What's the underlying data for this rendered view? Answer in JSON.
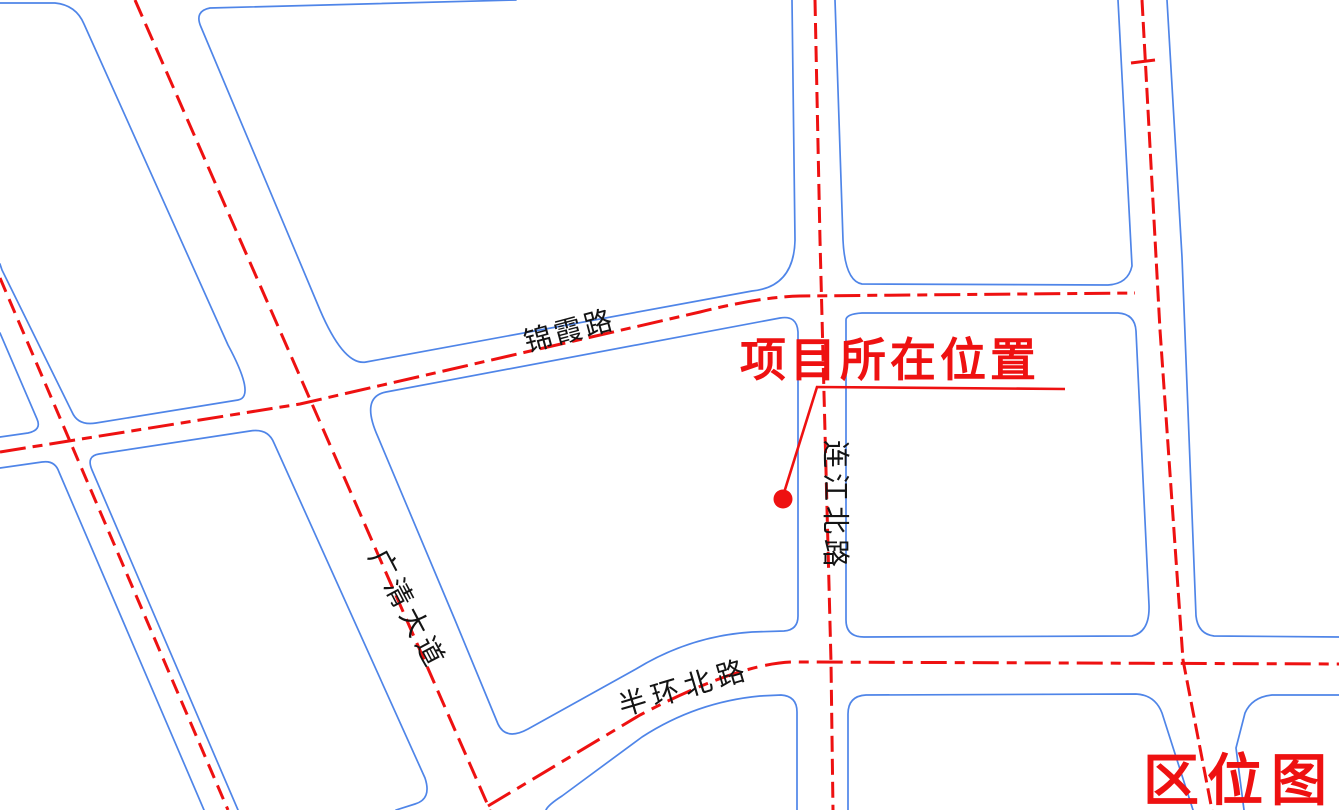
{
  "map": {
    "background": "#ffffff",
    "colors": {
      "road_edge": "#4f85e8",
      "centerline": "#ee1111",
      "road_label": "#141414",
      "annotation": "#ee1111"
    },
    "road_labels": [
      {
        "id": "jinxia-road",
        "text": "锦霞路"
      },
      {
        "id": "guangqing-ave",
        "text": "广清大道"
      },
      {
        "id": "lianjiang-north",
        "text": "连江北路"
      },
      {
        "id": "banhuan-north",
        "text": "半环北路"
      }
    ],
    "annotation": {
      "text": "项目所在位置"
    },
    "title": {
      "text": "区位图"
    }
  }
}
